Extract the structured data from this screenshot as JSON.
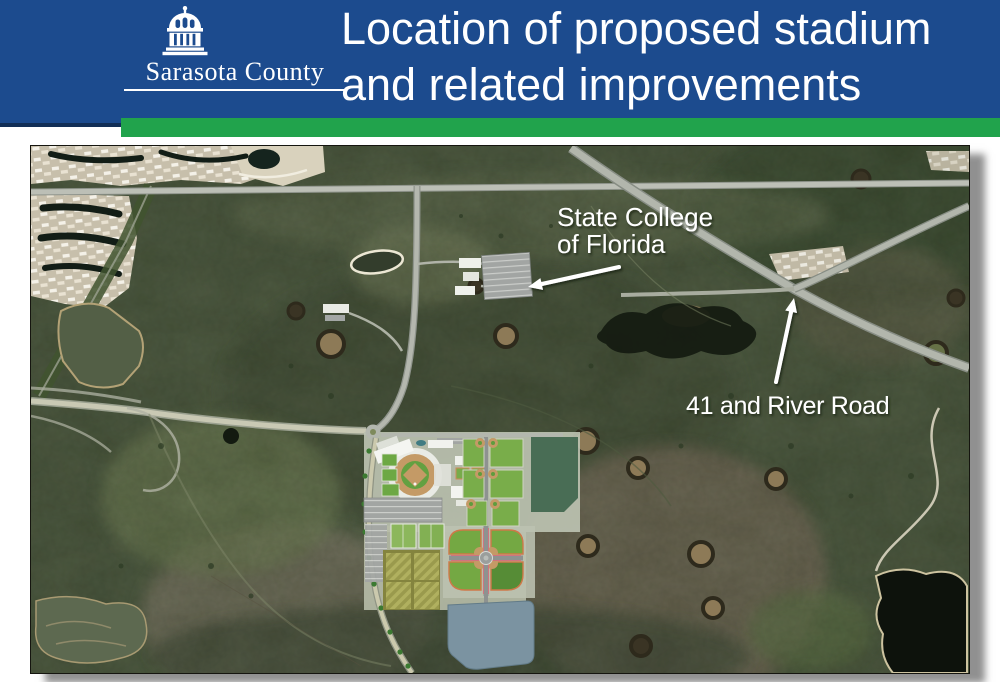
{
  "header": {
    "org_name": "Sarasota County",
    "title_line1": "Location of proposed stadium",
    "title_line2": "and related improvements",
    "colors": {
      "header_bg": "#1c4b8e",
      "accent_bar_green": "#21a34c",
      "title_text": "#ffffff",
      "logo_text": "#ffffff"
    }
  },
  "map": {
    "annotations": [
      {
        "id": "state-college-of-florida",
        "lines": [
          "State College",
          "of Florida"
        ],
        "text_color": "#ffffff"
      },
      {
        "id": "41-and-river-road",
        "label": "41 and River Road",
        "text_color": "#ffffff"
      }
    ]
  }
}
